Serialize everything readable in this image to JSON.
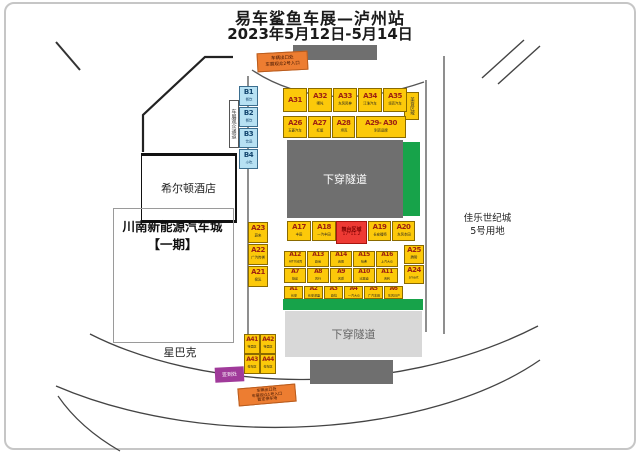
{
  "header": {
    "title": "易车鲨鱼车展—泸州站",
    "subtitle": "2023年5月12日-5月14日"
  },
  "places": {
    "hilton": "希尔顿酒店",
    "auto_city_line1": "川南新能源汽车城",
    "auto_city_line2": "【一期】",
    "starbucks": "星巴克",
    "jiale_line1": "佳乐世纪城",
    "jiale_line2": "5号用地"
  },
  "tunnels": {
    "top": "下穿隧道",
    "bottom": "下穿隧道"
  },
  "stage": {
    "line1": "舞台区域",
    "line2": "17*11.2"
  },
  "signs": {
    "gate_top": [
      "车辆出口处",
      "车展观众2号入口"
    ],
    "gate_bottom": [
      "车辆出口处",
      "车展观众1号入口",
      "暂定停车场"
    ],
    "walkway": "车展观众通道",
    "food_area": "美食区域",
    "checkin": "签到处"
  },
  "colors": {
    "booth_yellow": "#fcc90a",
    "green_strip": "#17a34a",
    "gate_orange": "#ed7d31",
    "stage_red": "#ee3a34",
    "checkin_purple": "#a03a9a",
    "snack_blue": "#b7e1f3",
    "tunnel_gray": "#6f6f6f"
  },
  "booth_groups": {
    "row_top": [
      {
        "code": "A31",
        "sub": ""
      },
      {
        "code": "A32",
        "sub": "哪吒"
      },
      {
        "code": "A33",
        "sub": "东风风神"
      },
      {
        "code": "A34",
        "sub": "江淮汽车"
      },
      {
        "code": "A35",
        "sub": "领克汽车"
      }
    ],
    "row_second": [
      {
        "code": "A26",
        "sub": "五菱汽车"
      },
      {
        "code": "A27",
        "sub": "红旗"
      },
      {
        "code": "A28",
        "sub": "坦克"
      },
      {
        "code": "A29- A30",
        "sub": "别克品牌"
      }
    ],
    "row_a17": [
      {
        "code": "A17",
        "sub": "丰田"
      },
      {
        "code": "A18",
        "sub": "一汽丰田"
      }
    ],
    "row_a19": [
      {
        "code": "A19",
        "sub": "长安福特"
      },
      {
        "code": "A20",
        "sub": "东风本田"
      }
    ],
    "row_a12": [
      {
        "code": "A12",
        "sub": "AITO问界"
      },
      {
        "code": "A13",
        "sub": "欧尚"
      },
      {
        "code": "A14",
        "sub": "启辰"
      },
      {
        "code": "A15",
        "sub": "哈弗"
      },
      {
        "code": "A16",
        "sub": "上汽大众"
      }
    ],
    "row_a7": [
      {
        "code": "A7",
        "sub": "捷途"
      },
      {
        "code": "A8",
        "sub": "风行"
      },
      {
        "code": "A9",
        "sub": "名爵"
      },
      {
        "code": "A10",
        "sub": "比亚迪"
      },
      {
        "code": "A11",
        "sub": "吉利"
      }
    ],
    "row_a1": [
      {
        "code": "A1",
        "sub": "长安"
      },
      {
        "code": "A2",
        "sub": "长安深蓝"
      },
      {
        "code": "A3",
        "sub": "欧拉"
      },
      {
        "code": "A4",
        "sub": "一汽大众"
      },
      {
        "code": "A5",
        "sub": "广汽本田"
      },
      {
        "code": "A6",
        "sub": "东风日产"
      }
    ],
    "col_left": [
      {
        "code": "A23",
        "sub": "蔚来"
      },
      {
        "code": "A22",
        "sub": "广汽传祺"
      },
      {
        "code": "A21",
        "sub": "极氪"
      }
    ],
    "col_right": [
      {
        "code": "A25",
        "sub": "腾势"
      },
      {
        "code": "A24",
        "sub": "smart"
      }
    ],
    "grid_sw": [
      {
        "code": "A41",
        "sub": "特卖区"
      },
      {
        "code": "A42",
        "sub": "特卖区"
      },
      {
        "code": "A43",
        "sub": "停车区"
      },
      {
        "code": "A44",
        "sub": "停车区"
      }
    ],
    "col_b": [
      {
        "code": "B1",
        "sub": "餐饮"
      },
      {
        "code": "B2",
        "sub": "餐饮"
      },
      {
        "code": "B3",
        "sub": "饮品"
      },
      {
        "code": "B4",
        "sub": "小吃"
      }
    ]
  }
}
